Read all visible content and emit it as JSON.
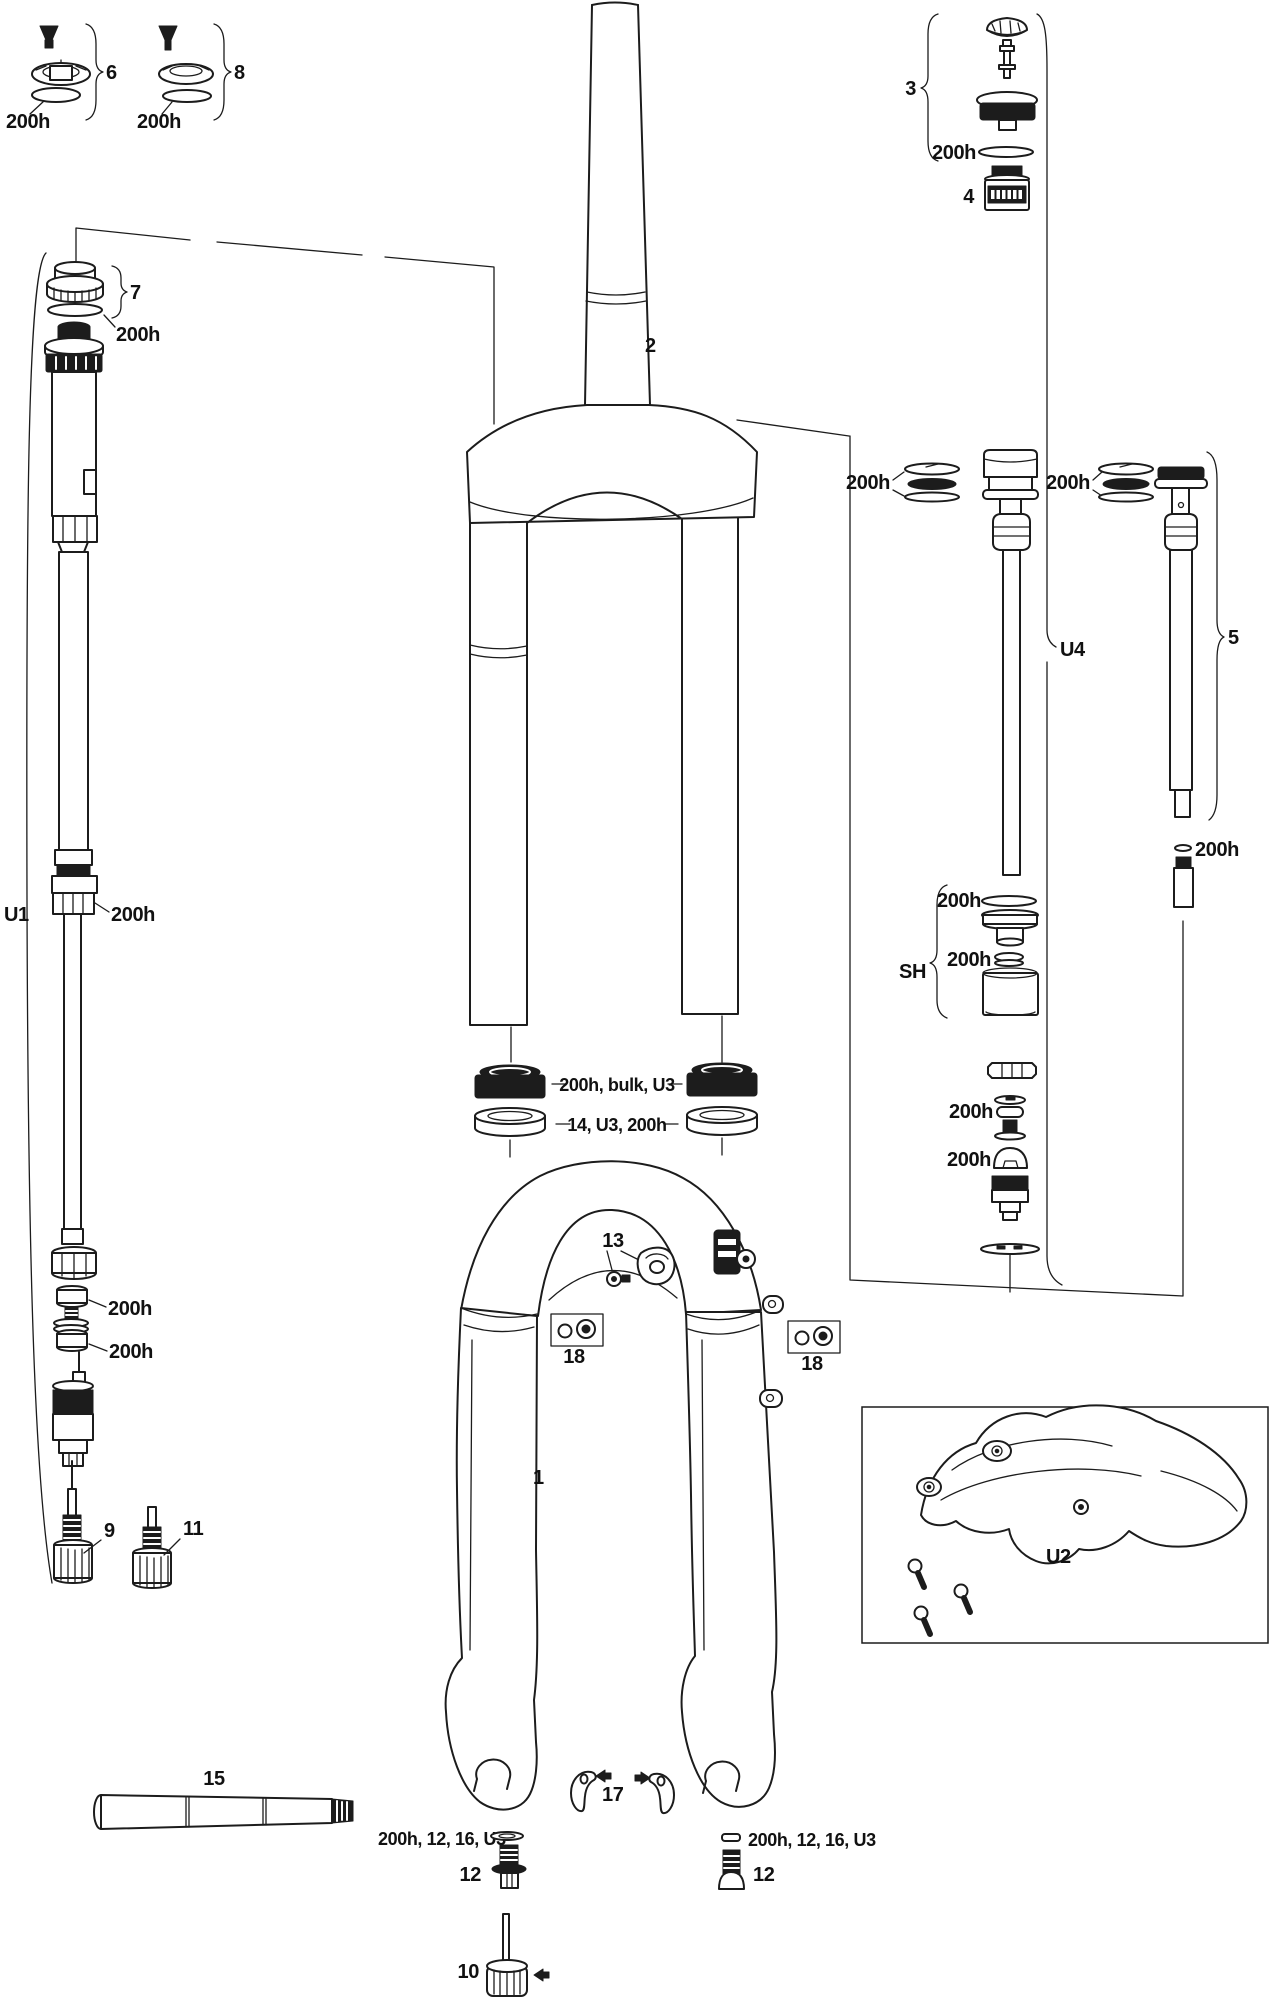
{
  "colors": {
    "line": "#1c1c1c",
    "background": "#ffffff"
  },
  "labels": {
    "h200": "200h",
    "seal_combo": "200h, bulk, U3",
    "foam_combo": "14, U3, 200h",
    "axle_bolt_combo": "200h, 12, 16, U3",
    "item1": "1",
    "item2": "2",
    "item3": "3",
    "item4": "4",
    "item5": "5",
    "item6": "6",
    "item7": "7",
    "item8": "8",
    "item9": "9",
    "item10": "10",
    "item11": "11",
    "item12": "12",
    "item13": "13",
    "item15": "15",
    "item17": "17",
    "item18": "18",
    "groupU1": "U1",
    "groupU2": "U2",
    "groupU4": "U4",
    "groupSH": "SH"
  }
}
